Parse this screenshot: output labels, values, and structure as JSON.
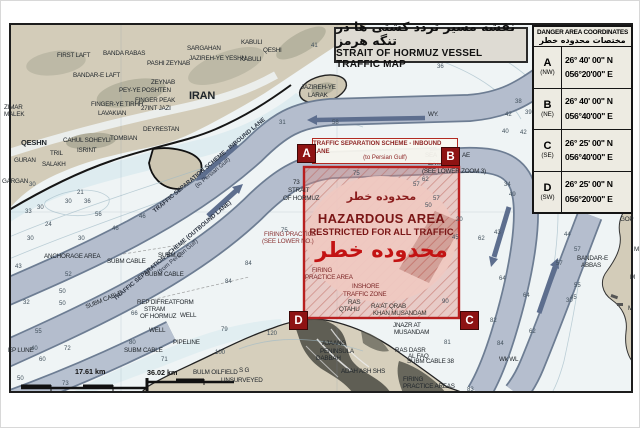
{
  "colors": {
    "hazard_red": "#b81f1f",
    "hazard_fill": "#e8a79e",
    "marker_red": "#8e1313",
    "lane_gray": "#b8c1d0",
    "arrow_gray": "#5d6e8e",
    "land_tan": "#d3ccb9",
    "sea": "#eff4f5",
    "shallow_blue": "#d8e9ee",
    "table_bg": "#edebe2",
    "title_bg": "#dedbd3"
  },
  "title": {
    "fa": "نقشه مسیر تردد کشتی ها در تنگه هرمز",
    "en": "STRAIT OF HORMUZ VESSEL TRAFFIC MAP"
  },
  "coordinates_table": {
    "header_en": "DANGER AREA COORDINATES",
    "header_ar": "مختصات محدوده خطر",
    "rows": [
      {
        "point": "A",
        "corner": "(NW)",
        "lat": "26° 40' 00\" N",
        "lon": "056°20'00\" E"
      },
      {
        "point": "B",
        "corner": "(NE)",
        "lat": "26° 40' 00\" N",
        "lon": "056°40'00\" E"
      },
      {
        "point": "C",
        "corner": "(SE)",
        "lat": "26° 25' 00\" N",
        "lon": "056°40'00\" E"
      },
      {
        "point": "D",
        "corner": "(SW)",
        "lat": "26° 25' 00\" N",
        "lon": "056°20'00\" E"
      }
    ]
  },
  "hazard": {
    "label_box_line1": "TRAFFIC SEPARATION SCHEME - INBOUND LANE",
    "label_box_line2": "(to Persian Gulf)",
    "fa_top": "محدوده خطر",
    "en_line1": "HAZARDOUS AREA",
    "en_line2": "RESTRICTED FOR ALL TRAFFIC",
    "fa_big": "محدوده خطر",
    "corners": [
      "A",
      "B",
      "C",
      "D"
    ]
  },
  "lanes": {
    "inbound_line1": "TRAFFIC SEPARATION SCHEME - INBOUND LANE",
    "inbound_line2": "(to Persian Gulf)",
    "outbound_line1": "TRAFFIC SEPARATION SCHEME (OUTBOUND LANE)",
    "outbound_line2": "(from Persian Gulf)"
  },
  "scale": {
    "d1": "17.61 km",
    "d2": "36.02 km"
  },
  "map": {
    "labels": [
      {
        "t": "FIRST LAFT",
        "x": 56,
        "y": 52
      },
      {
        "t": "BANDA RABAS",
        "x": 102,
        "y": 50
      },
      {
        "t": "PASHI ZEYNAB",
        "x": 146,
        "y": 60
      },
      {
        "t": "BANDAR-E LAFT",
        "x": 72,
        "y": 72
      },
      {
        "t": "ZEYNAB",
        "x": 150,
        "y": 79
      },
      {
        "t": "PEY-YE POSHTEN",
        "x": 118,
        "y": 87
      },
      {
        "t": "SARGAHAN",
        "x": 186,
        "y": 45
      },
      {
        "t": "JAZIREH-YE YESHN",
        "x": 188,
        "y": 55
      },
      {
        "t": "KABULI",
        "x": 240,
        "y": 39
      },
      {
        "t": "QESHI",
        "x": 262,
        "y": 47
      },
      {
        "t": "KABULI",
        "x": 239,
        "y": 56
      },
      {
        "t": "FINGER-YE TIRHH",
        "x": 90,
        "y": 101
      },
      {
        "t": "LAVAKIAN",
        "x": 97,
        "y": 110
      },
      {
        "t": "FINGER PEAK",
        "x": 134,
        "y": 97
      },
      {
        "t": "27INT JAZI",
        "x": 140,
        "y": 105
      },
      {
        "t": "ZIMAR",
        "x": 3,
        "y": 104
      },
      {
        "t": "MALEK",
        "x": 3,
        "y": 111
      },
      {
        "t": "IRAN",
        "x": 188,
        "y": 90,
        "s": 11,
        "b": 1
      },
      {
        "t": "JAZIREH-YE",
        "x": 300,
        "y": 84
      },
      {
        "t": "LARAK",
        "x": 307,
        "y": 92
      },
      {
        "t": "DEYRESTAN",
        "x": 142,
        "y": 126
      },
      {
        "t": "QESHN",
        "x": 20,
        "y": 138,
        "s": 7.5,
        "b": 1
      },
      {
        "t": "CAHUL SOHEYLI",
        "x": 62,
        "y": 137
      },
      {
        "t": "TOMBIAN",
        "x": 109,
        "y": 135
      },
      {
        "t": "ISRINT",
        "x": 76,
        "y": 147
      },
      {
        "t": "TRIL",
        "x": 49,
        "y": 150
      },
      {
        "t": "GURAN",
        "x": 13,
        "y": 157
      },
      {
        "t": "SALAKH",
        "x": 41,
        "y": 161
      },
      {
        "t": "GARGAN",
        "x": 1,
        "y": 178
      },
      {
        "t": "WY.",
        "x": 427,
        "y": 111
      },
      {
        "t": "73",
        "x": 292,
        "y": 179
      },
      {
        "t": "STRAIT",
        "x": 287,
        "y": 187
      },
      {
        "t": "OF HORMUZ",
        "x": 282,
        "y": 195
      },
      {
        "t": "ANCHORAGE AREA",
        "x": 43,
        "y": 253
      },
      {
        "t": "SUBM CABLE",
        "x": 106,
        "y": 258
      },
      {
        "t": "SUBM C.",
        "x": 157,
        "y": 252
      },
      {
        "t": "SUBM CABLE",
        "x": 144,
        "y": 271
      },
      {
        "t": "SUBM CABLE",
        "x": 84,
        "y": 304,
        "r": -22
      },
      {
        "t": "REP DIFREATFORM",
        "x": 136,
        "y": 299
      },
      {
        "t": "STRAM",
        "x": 143,
        "y": 306
      },
      {
        "t": "OF HORMUZ",
        "x": 139,
        "y": 313
      },
      {
        "t": "WELL",
        "x": 148,
        "y": 327
      },
      {
        "t": "SUBM CABLE",
        "x": 123,
        "y": 347
      },
      {
        "t": "EP LUNE",
        "x": 7,
        "y": 347
      },
      {
        "t": "WELL",
        "x": 179,
        "y": 312
      },
      {
        "t": "PIPELINE",
        "x": 172,
        "y": 339
      },
      {
        "t": "BULM OILFIELD",
        "x": 192,
        "y": 369
      },
      {
        "t": "S G",
        "x": 238,
        "y": 367
      },
      {
        "t": "UNSURVEYED",
        "x": 220,
        "y": 377
      },
      {
        "t": "AJAANG",
        "x": 321,
        "y": 340
      },
      {
        "t": "PENINSULA",
        "x": 319,
        "y": 348
      },
      {
        "t": "DABBAH",
        "x": 315,
        "y": 355
      },
      {
        "t": "ADAH ASH SHS",
        "x": 340,
        "y": 368
      },
      {
        "t": "JNAZR AT",
        "x": 392,
        "y": 322
      },
      {
        "t": "MUSANDAM",
        "x": 393,
        "y": 329
      },
      {
        "t": "RAS DASR",
        "x": 394,
        "y": 347
      },
      {
        "t": "AL FAQ",
        "x": 407,
        "y": 353
      },
      {
        "t": "SUBM CABLE 38",
        "x": 406,
        "y": 358
      },
      {
        "t": "FIRING",
        "x": 402,
        "y": 376
      },
      {
        "t": "PRACTICE AREAS",
        "x": 402,
        "y": 383
      },
      {
        "t": "Wk WL",
        "x": 498,
        "y": 356
      },
      {
        "t": "BANDAR-E",
        "x": 576,
        "y": 255
      },
      {
        "t": "ABBAS",
        "x": 580,
        "y": 262
      },
      {
        "t": "GOP",
        "x": 619,
        "y": 216
      },
      {
        "t": "M",
        "x": 633,
        "y": 246
      },
      {
        "t": "M",
        "x": 629,
        "y": 274
      },
      {
        "t": "M",
        "x": 627,
        "y": 305
      },
      {
        "t": "FIRING PRACTICE",
        "x": 263,
        "y": 231,
        "c": "#8a3434"
      },
      {
        "t": "(SEE LOWER NO.)",
        "x": 261,
        "y": 238,
        "c": "#8a3434"
      },
      {
        "t": "SEA",
        "x": 424,
        "y": 152
      },
      {
        "t": "AE",
        "x": 461,
        "y": 152
      },
      {
        "t": "EXT. AREA",
        "x": 427,
        "y": 160
      },
      {
        "t": "(SEE LOWER ZOOM 3)",
        "x": 421,
        "y": 168
      },
      {
        "t": "FIRING",
        "x": 311,
        "y": 267,
        "c": "#7c2626"
      },
      {
        "t": "PRACTICE AREA",
        "x": 304,
        "y": 274,
        "c": "#7c2626"
      },
      {
        "t": "INSHORE",
        "x": 351,
        "y": 283,
        "c": "#7c2626"
      },
      {
        "t": "TRAFFIC ZONE",
        "x": 342,
        "y": 291,
        "c": "#7c2626"
      },
      {
        "t": "RAS",
        "x": 347,
        "y": 299,
        "c": "#33302c"
      },
      {
        "t": "QTAHU",
        "x": 338,
        "y": 306,
        "c": "#33302c"
      },
      {
        "t": "RA'AT QRAB",
        "x": 370,
        "y": 303,
        "c": "#33302c"
      },
      {
        "t": "KHAN MUSANDAM",
        "x": 372,
        "y": 310,
        "c": "#33302c"
      }
    ],
    "depths": [
      [
        30,
        28,
        181
      ],
      [
        21,
        76,
        189
      ],
      [
        30,
        64,
        198
      ],
      [
        36,
        83,
        198
      ],
      [
        33,
        24,
        208
      ],
      [
        30,
        36,
        204
      ],
      [
        24,
        44,
        221
      ],
      [
        56,
        94,
        211
      ],
      [
        46,
        138,
        213
      ],
      [
        46,
        111,
        225
      ],
      [
        30,
        26,
        235
      ],
      [
        30,
        77,
        235
      ],
      [
        43,
        14,
        263
      ],
      [
        52,
        64,
        271
      ],
      [
        50,
        58,
        288
      ],
      [
        32,
        22,
        299
      ],
      [
        55,
        34,
        328
      ],
      [
        40,
        30,
        345
      ],
      [
        72,
        63,
        345
      ],
      [
        60,
        38,
        356
      ],
      [
        50,
        16,
        375
      ],
      [
        73,
        61,
        380
      ],
      [
        50,
        58,
        300
      ],
      [
        66,
        130,
        310
      ],
      [
        80,
        128,
        339
      ],
      [
        71,
        160,
        356
      ],
      [
        79,
        220,
        326
      ],
      [
        120,
        266,
        330
      ],
      [
        100,
        214,
        349
      ],
      [
        75,
        280,
        227
      ],
      [
        84,
        244,
        260
      ],
      [
        84,
        224,
        278
      ],
      [
        75,
        352,
        170
      ],
      [
        62,
        421,
        176
      ],
      [
        57,
        432,
        195
      ],
      [
        57,
        412,
        181
      ],
      [
        50,
        424,
        202
      ],
      [
        20,
        455,
        216
      ],
      [
        45,
        451,
        234
      ],
      [
        43,
        493,
        229
      ],
      [
        34,
        503,
        181
      ],
      [
        49,
        508,
        191
      ],
      [
        36,
        436,
        63
      ],
      [
        38,
        514,
        98
      ],
      [
        42,
        504,
        111
      ],
      [
        39,
        524,
        109
      ],
      [
        40,
        501,
        128
      ],
      [
        42,
        519,
        129
      ],
      [
        41,
        310,
        42
      ],
      [
        31,
        278,
        119
      ],
      [
        58,
        331,
        119
      ],
      [
        44,
        558,
        197
      ],
      [
        42,
        571,
        207
      ],
      [
        44,
        563,
        231
      ],
      [
        57,
        573,
        246
      ],
      [
        57,
        555,
        260
      ],
      [
        62,
        477,
        235
      ],
      [
        64,
        498,
        275
      ],
      [
        64,
        522,
        292
      ],
      [
        55,
        573,
        282
      ],
      [
        45,
        569,
        294
      ],
      [
        30,
        565,
        297
      ],
      [
        27,
        561,
        192
      ],
      [
        82,
        489,
        317
      ],
      [
        84,
        496,
        340
      ],
      [
        62,
        528,
        328
      ],
      [
        83,
        466,
        386
      ],
      [
        81,
        443,
        339
      ],
      [
        90,
        441,
        298
      ]
    ]
  }
}
